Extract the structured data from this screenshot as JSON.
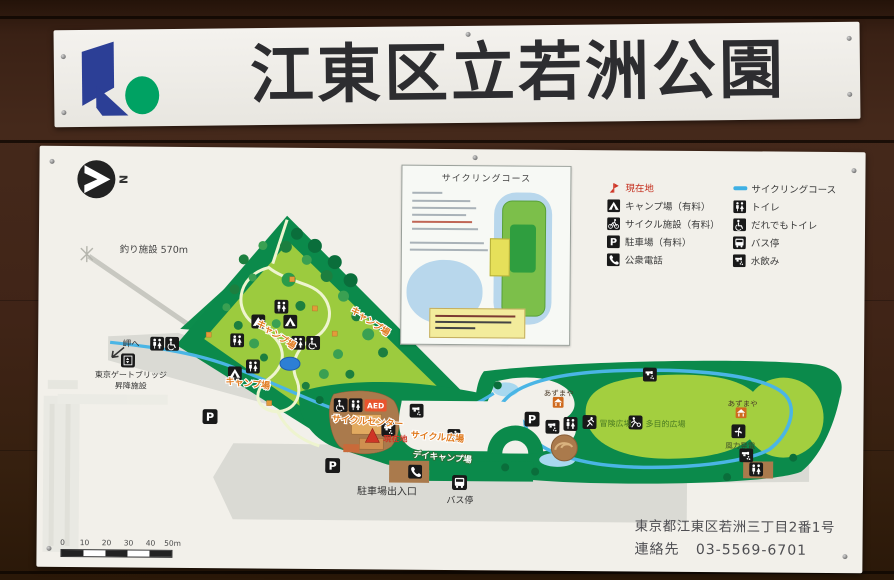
{
  "sign": {
    "title": "江東区立若洲公園"
  },
  "compass": {
    "label": "N"
  },
  "glyphs": {
    "parking": "P"
  },
  "inset": {
    "title": "サイクリングコース"
  },
  "legend": {
    "left": [
      {
        "icon": "current-location-icon",
        "label": "現在地"
      },
      {
        "icon": "campsite-icon",
        "label": "キャンプ場（有料）"
      },
      {
        "icon": "cycle-facility-icon",
        "label": "サイクル施設（有料）"
      },
      {
        "icon": "parking-icon",
        "label": "駐車場（有料）"
      },
      {
        "icon": "phone-icon",
        "label": "公衆電話"
      }
    ],
    "right": [
      {
        "icon": "cycling-course-line",
        "label": "サイクリングコース"
      },
      {
        "icon": "toilet-icon",
        "label": "トイレ"
      },
      {
        "icon": "accessible-toilet-icon",
        "label": "だれでもトイレ"
      },
      {
        "icon": "bus-stop-icon",
        "label": "バス停"
      },
      {
        "icon": "water-fountain-icon",
        "label": "水飲み"
      }
    ]
  },
  "map": {
    "labels": {
      "fishing": "釣り施設 570m",
      "to_cape": "岬へ",
      "gate_bridge_1": "東京ゲートブリッジ",
      "gate_bridge_2": "昇降施設",
      "camp_1": "キャンプ場",
      "camp_2": "キャンプ場",
      "camp_3": "キャンプ場",
      "cycle_center": "サイクルセンター",
      "aed": "AED",
      "current_location": "現在地",
      "cycle_plaza": "サイクル広場",
      "day_camp": "デイキャンプ場",
      "parking_entrance": "駐車場出入口",
      "bus_stop": "バス停",
      "azumaya_west": "あずまや",
      "azumaya_east": "あずまや",
      "adventure_plaza": "冒険広場",
      "multipurpose_plaza": "多目的広場",
      "wind_power": "風力発電"
    },
    "scale_ticks": [
      "0",
      "10",
      "20",
      "30",
      "40",
      "50m"
    ]
  },
  "footer": {
    "address": "東京都江東区若洲三丁目2番1号",
    "contact_label": "連絡先",
    "phone": "03-5569-6701"
  },
  "icons": {
    "koto-ward-logo": "blue k mark with green dot",
    "north-compass-icon": "white arrow in black circle",
    "current-location-icon": "red flag marker",
    "campsite-icon": "white tent on black square",
    "cycle-facility-icon": "white cyclist on black square",
    "parking-icon": "white P on black square",
    "phone-icon": "white handset on black square",
    "cycling-course-line": "light blue line",
    "toilet-icon": "restroom figures on black square",
    "accessible-toilet-icon": "wheelchair figure on black square",
    "bus-stop-icon": "white bus on black square",
    "water-fountain-icon": "white tap with droplets on black square",
    "wind-turbine-icon": "white turbine on black square",
    "adventure-plaza-icon": "climbing figure on black square",
    "multipurpose-plaza-icon": "figure with ball on black square",
    "elevator-icon": "up-down arrows on black square",
    "gazebo-icon": "white gazebo on orange square",
    "aed-badge": "white AED on orange rectangle"
  },
  "colors": {
    "wood": "#3a2115",
    "panel": "#f2f0ea",
    "green_dark": "#0b8a4b",
    "green_light": "#9ccb3e",
    "course_blue": "#3fb0e4",
    "road_gray": "#dadad4",
    "building_brown": "#aa7a4c",
    "marker_red": "#cf3526",
    "aed_orange": "#e8542e",
    "logo_blue": "#2c3f96",
    "logo_green": "#00a263"
  }
}
